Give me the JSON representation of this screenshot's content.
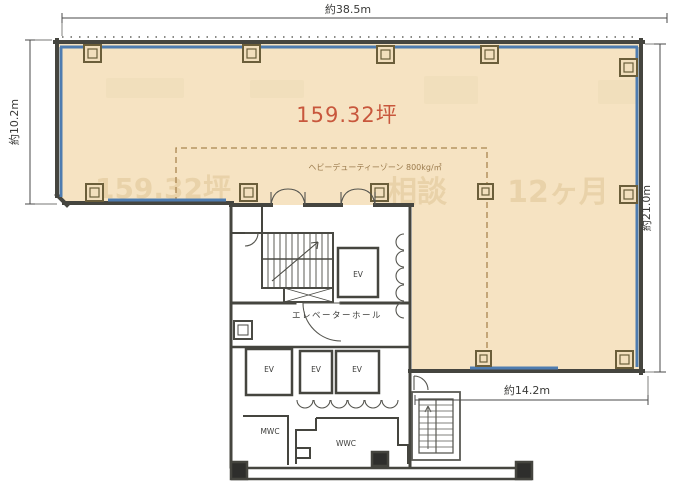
{
  "dimensions": {
    "top": "約38.5m",
    "left": "約10.2m",
    "right": "約21.0m",
    "bottom": "約14.2m"
  },
  "area_label": "159.32坪",
  "heavy_duty_zone_label": "ヘビーデューティーゾーン 800kg/㎡",
  "labels": {
    "elevator_hall": "エレベーターホール",
    "elevator": "EV",
    "mens_wc": "MWC",
    "womens_wc": "WWC"
  },
  "watermarks": {
    "area": "159.32坪",
    "consult": "相談",
    "months": "12ヶ月"
  },
  "colors": {
    "floor_fill": "#f6e3c2",
    "window_blue": "#4e7cb0",
    "wall_gray": "#45453f",
    "area_text_red": "#c8573c",
    "zone_dash_brown": "#aa8650",
    "dimension_text": "#3a3a38",
    "watermark_tan": "#e7d0a5",
    "column_outline": "#6b5e3a"
  }
}
